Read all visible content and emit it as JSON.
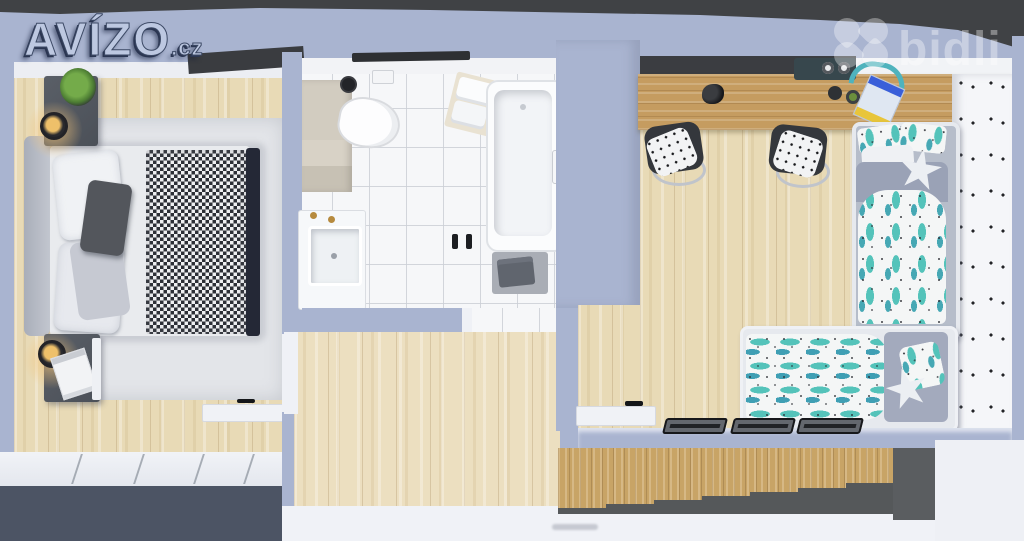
{
  "branding": {
    "avizo_logo": {
      "text": "AVÍZO",
      "suffix": ".cz"
    },
    "bidli_logo": {
      "text": "bidli",
      "icon": "bidli-petals-icon"
    }
  },
  "palette": {
    "wall_periwinkle": "#a9b4d0",
    "background_dark_band": "#404245",
    "floor_wood_light": "#e8dab6",
    "desk_wood": "#c59c60",
    "stairs_wood": "#c8a466",
    "wardrobe_front_slate": "#4c5464",
    "rug_gray": "#e3e5e9",
    "bed_footboard_navy": "#242836",
    "accent_teal": "#54c3ba",
    "tile_white": "#f6f7f9",
    "faucet_gold": "#b68a3e"
  },
  "scene": {
    "view": "top-down 3D render of an apartment",
    "rooms": [
      {
        "name": "bedroom",
        "items": [
          "double-bed",
          "headboard",
          "white-pillows",
          "dark-accent-pillow",
          "houndstooth-blanket",
          "nightstand-with-plant",
          "nightstand-with-magazine",
          "wall-lamp",
          "wall-lamp",
          "area-rug",
          "wardrobe",
          "wall-console-shelf"
        ]
      },
      {
        "name": "bathroom",
        "items": [
          "toilet",
          "vanity-counter",
          "toilet-brush",
          "paper-holder",
          "towel-shelf",
          "bathtub",
          "tub-faucet",
          "bath-mat",
          "towel",
          "washbasin",
          "gold-taps",
          "shower-door-handles"
        ]
      },
      {
        "name": "hallway",
        "items": [
          "wood-floor",
          "door-opening-to-bedroom",
          "door-opening-to-bathroom"
        ]
      },
      {
        "name": "kids-room",
        "items": [
          "long-wall-desk",
          "dark-pinboard",
          "desk-lamp",
          "desk-shelf-with-speakers",
          "headphones",
          "notebook",
          "desk-chair",
          "desk-chair",
          "bed-with-cactus-bedding",
          "bed-with-teal-print-bedding",
          "star-pillow",
          "star-pillow",
          "polka-accent-wall",
          "wall-frames",
          "wall-console-shelf"
        ]
      },
      {
        "name": "staircase",
        "items": [
          "wood-steps",
          "stair-shadow"
        ]
      }
    ]
  }
}
